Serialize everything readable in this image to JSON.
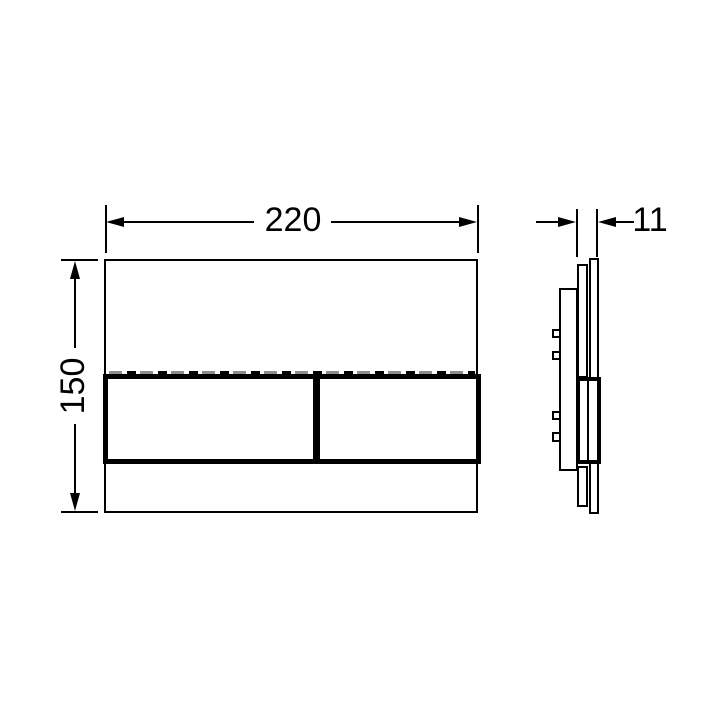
{
  "drawing": {
    "kind": "technical-dimension-drawing",
    "background": "#ffffff",
    "line_color": "#000000",
    "hidden_edge_color": "#8e8e8e",
    "dimensions": {
      "width": {
        "value": "220"
      },
      "height": {
        "value": "150"
      },
      "depth": {
        "value": "11"
      }
    }
  }
}
